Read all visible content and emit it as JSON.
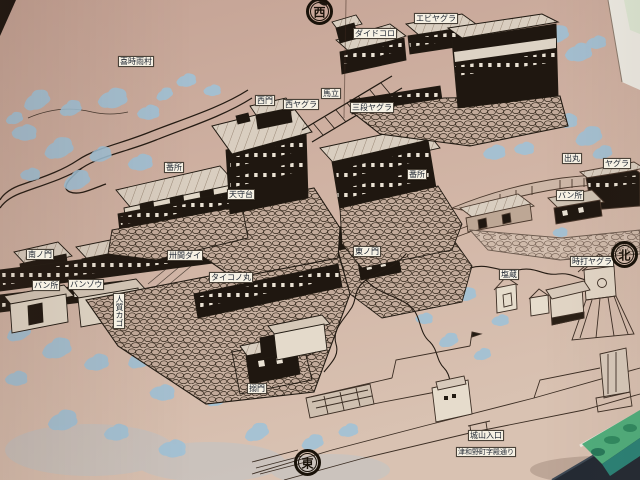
{
  "labels": {
    "kijigure_village": "喜時雨村",
    "west_gate": "西門",
    "west_yagura": "西ヤグラ",
    "umadate": "馬立",
    "sandan_yagura": "三段ヤグラ",
    "daidokoro": "ダイドコロ",
    "ebi_yagura": "エビヤグラ",
    "bansho_west": "番所",
    "tenshudai": "天守台",
    "bansho_center": "番所",
    "demaru": "出丸",
    "yagura": "ヤグラ",
    "bansho_demaru": "バン所",
    "minami_no_mon": "南ノ門",
    "bansho_south": "バン所",
    "banzou": "バンゾウ",
    "sanjukken_dai": "卅間ダイ",
    "taiko_no_maru": "タイコノ丸",
    "hitojichi_kago": "人質カゴ",
    "higashi_no_mon": "東ノ門",
    "karame_mon": "搦門",
    "tokiuchi_yagura": "時打ヤグラ",
    "shiogura": "塩蔵",
    "shiroyama_entrance": "城山入口",
    "street_note": "津和野町字殿通り"
  },
  "compass": {
    "west": "西",
    "north": "北",
    "east": "東"
  },
  "colors": {
    "wall": "#cfb2a4",
    "ink": "#211a12",
    "tree_blue": "#9fc2d8",
    "label_bg": "#f6f1e4",
    "model_green": "#4fae7c"
  }
}
